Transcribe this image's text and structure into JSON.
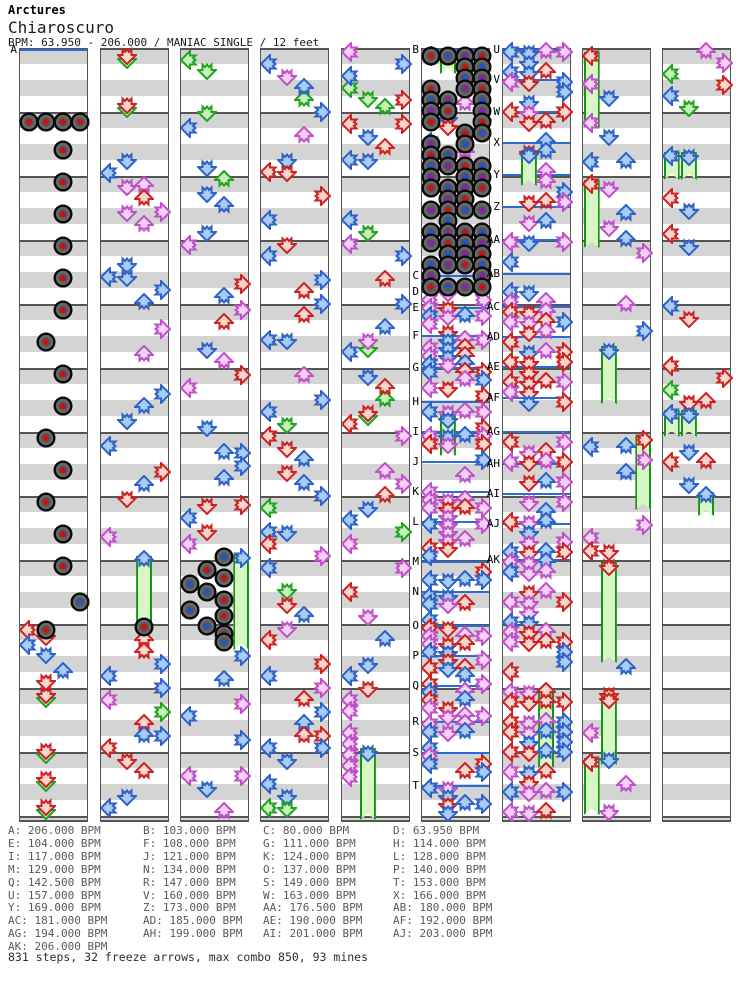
{
  "header": {
    "artist": "Arctures",
    "title": "Chiaroscuro",
    "info": "BPM: 63.950 - 206.000 / MANIAC SINGLE / 12 feet"
  },
  "footer": {
    "summary": "831 steps, 32 freeze arrows, max combo 850, 93 mines"
  },
  "stats": {
    "steps": 831,
    "freeze_arrows": 32,
    "max_combo": 850,
    "mines": 93
  },
  "palette": {
    "red_outline": "#cc2222",
    "red_fill": "#f8d6ce",
    "blue_outline": "#2e62c8",
    "blue_fill": "#a9cdf2",
    "violet_outline": "#c050c8",
    "violet_fill": "#f4d2f6",
    "green_outline": "#1fa41f",
    "green_fill": "#c8eebc",
    "freeze_fill": "#d6f6c4",
    "freeze_border": "#159315",
    "mine_body": "#696969",
    "mine_ring": "#0a0a0a",
    "mine_red": "#cc1111",
    "mine_blue": "#2255cc",
    "mine_purple": "#8822aa",
    "stripe_gray": "#d4d4d4",
    "line_gray": "#555555",
    "bpm_line": "#2b6bd8",
    "list_text": "#595959"
  },
  "chart": {
    "seed": 20061,
    "top": 48,
    "height": 774,
    "col_width": 69,
    "lane_pitch": 17.25,
    "lane_dirs": [
      "left",
      "down",
      "up",
      "right"
    ],
    "bpm_list_layout": {
      "x": [
        8,
        143,
        263,
        393
      ],
      "y0": 825,
      "row_h": 12.9,
      "cols": 4
    },
    "bpm_changes": [
      {
        "label": "A",
        "bpm": "206.000"
      },
      {
        "label": "B",
        "bpm": "103.000"
      },
      {
        "label": "C",
        "bpm": "80.000"
      },
      {
        "label": "D",
        "bpm": "63.950"
      },
      {
        "label": "E",
        "bpm": "104.000"
      },
      {
        "label": "F",
        "bpm": "108.000"
      },
      {
        "label": "G",
        "bpm": "111.000"
      },
      {
        "label": "H",
        "bpm": "114.000"
      },
      {
        "label": "I",
        "bpm": "117.000"
      },
      {
        "label": "J",
        "bpm": "121.000"
      },
      {
        "label": "K",
        "bpm": "124.000"
      },
      {
        "label": "L",
        "bpm": "128.000"
      },
      {
        "label": "M",
        "bpm": "129.000"
      },
      {
        "label": "N",
        "bpm": "134.000"
      },
      {
        "label": "O",
        "bpm": "137.000"
      },
      {
        "label": "P",
        "bpm": "140.000"
      },
      {
        "label": "Q",
        "bpm": "142.500"
      },
      {
        "label": "R",
        "bpm": "147.000"
      },
      {
        "label": "S",
        "bpm": "149.000"
      },
      {
        "label": "T",
        "bpm": "153.000"
      },
      {
        "label": "U",
        "bpm": "157.000"
      },
      {
        "label": "V",
        "bpm": "160.000"
      },
      {
        "label": "W",
        "bpm": "163.000"
      },
      {
        "label": "X",
        "bpm": "166.000"
      },
      {
        "label": "Y",
        "bpm": "169.000"
      },
      {
        "label": "Z",
        "bpm": "173.000"
      },
      {
        "label": "AA",
        "bpm": "176.500"
      },
      {
        "label": "AB",
        "bpm": "180.000"
      },
      {
        "label": "AC",
        "bpm": "181.000"
      },
      {
        "label": "AD",
        "bpm": "185.000"
      },
      {
        "label": "AE",
        "bpm": "190.000"
      },
      {
        "label": "AF",
        "bpm": "192.000"
      },
      {
        "label": "AG",
        "bpm": "194.000"
      },
      {
        "label": "AH",
        "bpm": "199.000"
      },
      {
        "label": "AI",
        "bpm": "201.000"
      },
      {
        "label": "AJ",
        "bpm": "203.000"
      },
      {
        "label": "AK",
        "bpm": "206.000"
      }
    ],
    "columns": [
      {
        "x": 19,
        "markers": [
          [
            "A",
            50
          ]
        ],
        "mines": [
          [
            0,
            122,
            "red"
          ],
          [
            1,
            122,
            "red"
          ],
          [
            2,
            122,
            "red"
          ],
          [
            3,
            122,
            "red"
          ],
          [
            2,
            150,
            "red"
          ],
          [
            2,
            182,
            "red"
          ],
          [
            2,
            214,
            "red"
          ],
          [
            2,
            246,
            "red"
          ],
          [
            2,
            278,
            "red"
          ],
          [
            2,
            310,
            "red"
          ],
          [
            1,
            342,
            "red"
          ],
          [
            2,
            374,
            "red"
          ],
          [
            2,
            406,
            "red"
          ],
          [
            1,
            438,
            "red"
          ],
          [
            2,
            470,
            "red"
          ],
          [
            1,
            502,
            "red"
          ],
          [
            2,
            534,
            "red"
          ],
          [
            2,
            566,
            "red"
          ],
          [
            3,
            602,
            "blue"
          ],
          [
            1,
            630,
            "red"
          ]
        ],
        "freezes": [],
        "notes": [
          [
            0,
            630,
            "red"
          ],
          [
            1,
            694,
            "red",
            "gallop"
          ],
          [
            1,
            750,
            "red",
            "gallop"
          ],
          [
            1,
            778,
            "red",
            "gallop"
          ],
          [
            1,
            806,
            "red",
            "gallop"
          ]
        ],
        "segments": [
          {
            "y0": 636,
            "y1": 688,
            "step": 9,
            "density": 0.85,
            "palette": "mixed"
          }
        ]
      },
      {
        "x": 100,
        "markers": [],
        "mines": [
          [
            2,
            627,
            "red"
          ]
        ],
        "freezes": [
          [
            2,
            556,
            622,
            "blue"
          ]
        ],
        "notes": [
          [
            1,
            55,
            "red",
            "gallop"
          ],
          [
            1,
            104,
            "red",
            "gallop"
          ],
          [
            2,
            640,
            "red"
          ]
        ],
        "segments": [
          {
            "y0": 160,
            "y1": 550,
            "step": 13,
            "density": 0.72,
            "palette": "mixed"
          },
          {
            "y0": 652,
            "y1": 816,
            "step": 12,
            "density": 0.75,
            "palette": "mixed"
          }
        ]
      },
      {
        "x": 180,
        "markers": [],
        "mines": [
          [
            2,
            557,
            "blue"
          ],
          [
            1,
            570,
            "red"
          ],
          [
            2,
            578,
            "red"
          ],
          [
            0,
            584,
            "blue"
          ],
          [
            1,
            592,
            "blue"
          ],
          [
            2,
            600,
            "red"
          ],
          [
            0,
            610,
            "blue"
          ],
          [
            2,
            616,
            "red"
          ],
          [
            1,
            626,
            "blue"
          ],
          [
            2,
            634,
            "red"
          ],
          [
            2,
            642,
            "blue"
          ]
        ],
        "freezes": [
          [
            3,
            554,
            650,
            "blue"
          ]
        ],
        "notes": [
          [
            0,
            60,
            "green"
          ],
          [
            1,
            70,
            "green"
          ],
          [
            1,
            112,
            "green"
          ]
        ],
        "segments": [
          {
            "y0": 128,
            "y1": 548,
            "step": 13,
            "density": 0.7,
            "palette": "mixed"
          },
          {
            "y0": 656,
            "y1": 816,
            "step": 12,
            "density": 0.72,
            "palette": "mixed"
          }
        ]
      },
      {
        "x": 260,
        "markers": [],
        "mines": [],
        "freezes": [],
        "notes": [
          [
            2,
            100,
            "green"
          ],
          [
            1,
            590,
            "green"
          ]
        ],
        "segments": [
          {
            "y0": 52,
            "y1": 816,
            "step": 12,
            "density": 0.75,
            "palette": "mixed"
          }
        ]
      },
      {
        "x": 341,
        "markers": [],
        "mines": [],
        "freezes": [
          [
            1,
            748,
            820,
            "blue"
          ]
        ],
        "notes": [
          [
            0,
            88,
            "green"
          ],
          [
            1,
            98,
            "green"
          ],
          [
            2,
            108,
            "green"
          ],
          [
            1,
            348,
            "green"
          ],
          [
            2,
            400,
            "green"
          ],
          [
            1,
            416,
            "green"
          ]
        ],
        "segments": [
          {
            "y0": 52,
            "y1": 696,
            "step": 12,
            "density": 0.7,
            "palette": "mixed"
          },
          {
            "y0": 700,
            "y1": 790,
            "step": 11,
            "density": 0.9,
            "palette": "violet",
            "lanes": [
              0
            ]
          }
        ]
      },
      {
        "x": 421,
        "markers": [
          [
            "B",
            50
          ],
          [
            "C",
            276
          ],
          [
            "D",
            292
          ],
          [
            "E",
            308
          ],
          [
            "F",
            336
          ],
          [
            "G",
            368
          ],
          [
            "H",
            402
          ],
          [
            "I",
            432
          ],
          [
            "J",
            462
          ],
          [
            "K",
            492
          ],
          [
            "L",
            522
          ],
          [
            "M",
            562
          ],
          [
            "N",
            592
          ],
          [
            "O",
            626
          ],
          [
            "P",
            656
          ],
          [
            "Q",
            686
          ],
          [
            "R",
            722
          ],
          [
            "S",
            753
          ],
          [
            "T",
            786
          ]
        ],
        "mines": [],
        "minefield": {
          "y0": 56,
          "y1": 288,
          "step": 11,
          "density": 0.62
        },
        "freezes": [
          [
            1,
            50,
            74,
            null
          ],
          [
            1,
            415,
            456,
            "blue"
          ]
        ],
        "notes": [
          [
            0,
            56,
            "red"
          ],
          [
            2,
            104,
            "violet"
          ],
          [
            3,
            120,
            "violet"
          ],
          [
            1,
            118,
            "blue"
          ],
          [
            1,
            126,
            "red"
          ],
          [
            0,
            142,
            "blue"
          ],
          [
            2,
            152,
            "violet"
          ],
          [
            2,
            164,
            "violet"
          ],
          [
            2,
            176,
            "violet"
          ],
          [
            2,
            250,
            "violet"
          ],
          [
            1,
            262,
            "blue"
          ],
          [
            0,
            282,
            "blue"
          ]
        ],
        "segments": [
          {
            "y0": 292,
            "y1": 816,
            "step": 8,
            "density": 0.82,
            "palette": "quad"
          }
        ]
      },
      {
        "x": 502,
        "markers": [
          [
            "U",
            50
          ],
          [
            "V",
            80
          ],
          [
            "W",
            112
          ],
          [
            "X",
            143
          ],
          [
            "Y",
            175
          ],
          [
            "Z",
            207
          ],
          [
            "AA",
            240
          ],
          [
            "AB",
            274
          ],
          [
            "AC",
            307
          ],
          [
            "AD",
            337
          ],
          [
            "AE",
            367
          ],
          [
            "AF",
            398
          ],
          [
            "AG",
            432
          ],
          [
            "AH",
            464
          ],
          [
            "AI",
            494
          ],
          [
            "AJ",
            524
          ],
          [
            "AK",
            560
          ]
        ],
        "mines": [],
        "freezes": [
          [
            1,
            150,
            186,
            "blue"
          ],
          [
            2,
            688,
            768,
            "red"
          ]
        ],
        "notes": [],
        "segments": [
          {
            "y0": 52,
            "y1": 816,
            "step": 10,
            "density": 0.8,
            "palette": "quad"
          }
        ]
      },
      {
        "x": 582,
        "markers": [],
        "mines": [],
        "freezes": [
          [
            0,
            52,
            128,
            "red"
          ],
          [
            0,
            180,
            248,
            "red"
          ],
          [
            1,
            346,
            404,
            "blue"
          ],
          [
            3,
            436,
            510,
            "red"
          ],
          [
            1,
            562,
            663,
            "red"
          ],
          [
            1,
            695,
            765,
            "red"
          ],
          [
            0,
            758,
            815,
            "red"
          ]
        ],
        "notes": [],
        "segments": [
          {
            "y0": 58,
            "y1": 344,
            "step": 13,
            "density": 0.55,
            "palette": "mixed"
          },
          {
            "y0": 408,
            "y1": 556,
            "step": 13,
            "density": 0.55,
            "palette": "mixed"
          },
          {
            "y0": 668,
            "y1": 816,
            "step": 13,
            "density": 0.5,
            "palette": "mixed"
          }
        ]
      },
      {
        "x": 662,
        "markers": [],
        "mines": [],
        "freezes": [
          [
            0,
            152,
            180,
            "blue"
          ],
          [
            1,
            152,
            180,
            "blue"
          ],
          [
            0,
            410,
            437,
            "blue"
          ],
          [
            1,
            410,
            437,
            "blue"
          ],
          [
            2,
            492,
            516,
            "blue"
          ]
        ],
        "notes": [],
        "segments": [
          {
            "y0": 52,
            "y1": 148,
            "step": 11,
            "density": 0.7,
            "palette": "mixed"
          },
          {
            "y0": 186,
            "y1": 406,
            "step": 12,
            "density": 0.62,
            "palette": "mixed"
          },
          {
            "y0": 440,
            "y1": 490,
            "step": 11,
            "density": 0.7,
            "palette": "mixed"
          }
        ]
      }
    ]
  }
}
